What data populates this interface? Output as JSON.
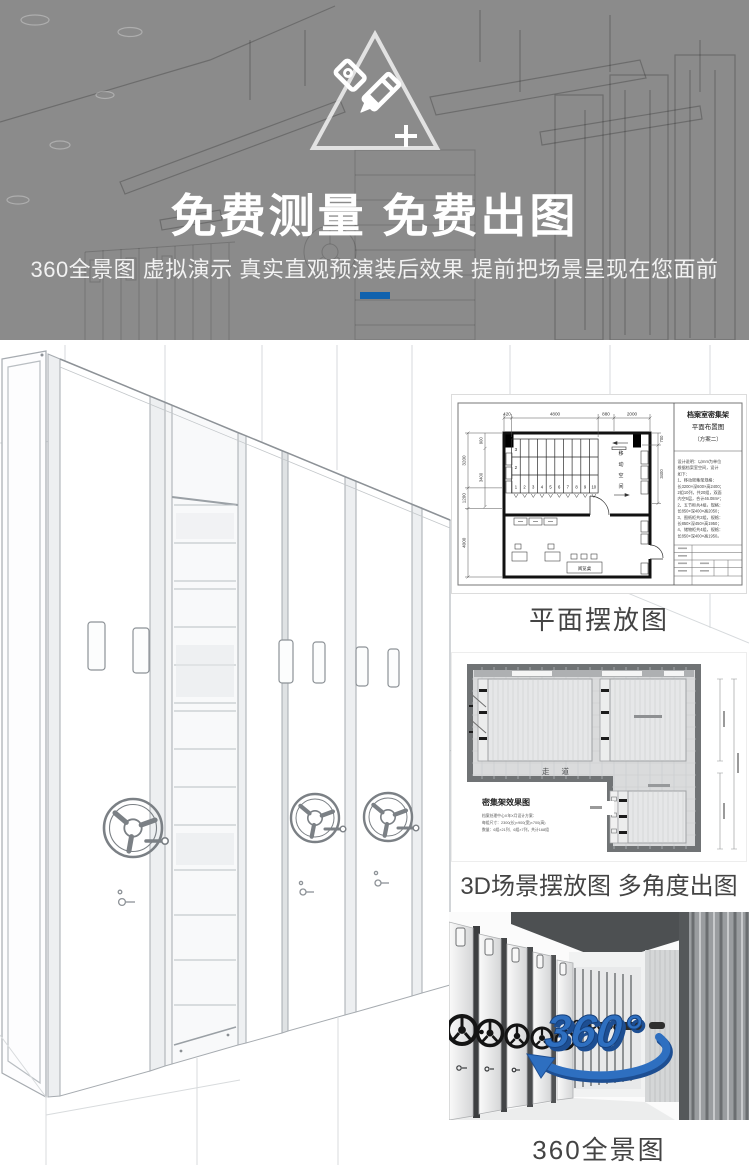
{
  "colors": {
    "accent": "#1062ae",
    "logo_blue": "#2e6fc0",
    "banner_gray": "#8b8b8b"
  },
  "banner": {
    "title": "免费测量 免费出图",
    "subtitle": "360全景图 虚拟演示 真实直观预演装后效果 提前把场景呈现在您面前"
  },
  "floor_plan": {
    "caption": "平面摆放图",
    "title_block": {
      "line1": "档案室密集架",
      "line2": "平面布置图",
      "line3": "（方案二）"
    },
    "dims_top": [
      "420",
      "4800",
      "880",
      "2000"
    ],
    "dims_left_outer": [
      "3200",
      "1200",
      "4000"
    ],
    "dims_left_inner": [
      "900",
      "3400"
    ],
    "dims_right": [
      "700",
      "3400"
    ],
    "row_labels": [
      "3",
      "2"
    ],
    "stack_numbers": [
      "1",
      "2",
      "3",
      "4",
      "5",
      "6",
      "7",
      "8",
      "9",
      "10"
    ],
    "moving_space_chars": [
      "移",
      "动",
      "空",
      "间"
    ],
    "reading_table": "阅览桌",
    "notes": [
      "设计说明：以mm为单位",
      "根据档案室空间，设计",
      "如下：",
      "1、移动密集架规格：",
      "长3200×深600×高2400；",
      "2组10列，共20组，双面",
      "内空6层，合计46.08m²；",
      "2、五节柜共4组，规格：",
      "长850×深400×高2050；",
      "3、图纸柜共2组，规格：",
      "长850×深450×高1950；",
      "4、储物柜共4组，规格：",
      "长850×深400×高1950。"
    ]
  },
  "scene3d": {
    "caption": "3D场景摆放图 多角度出图",
    "aisle": "走 道",
    "legend_title": "密集架效果图",
    "legend_lines": [
      "档案处理中心X年X月设计方案：",
      "每组尺寸：2300(长)×900(宽)×700(高)",
      "数量：6组×21列、6组×7列，共计168组"
    ]
  },
  "pano": {
    "caption": "360全景图",
    "logo": "360°"
  }
}
